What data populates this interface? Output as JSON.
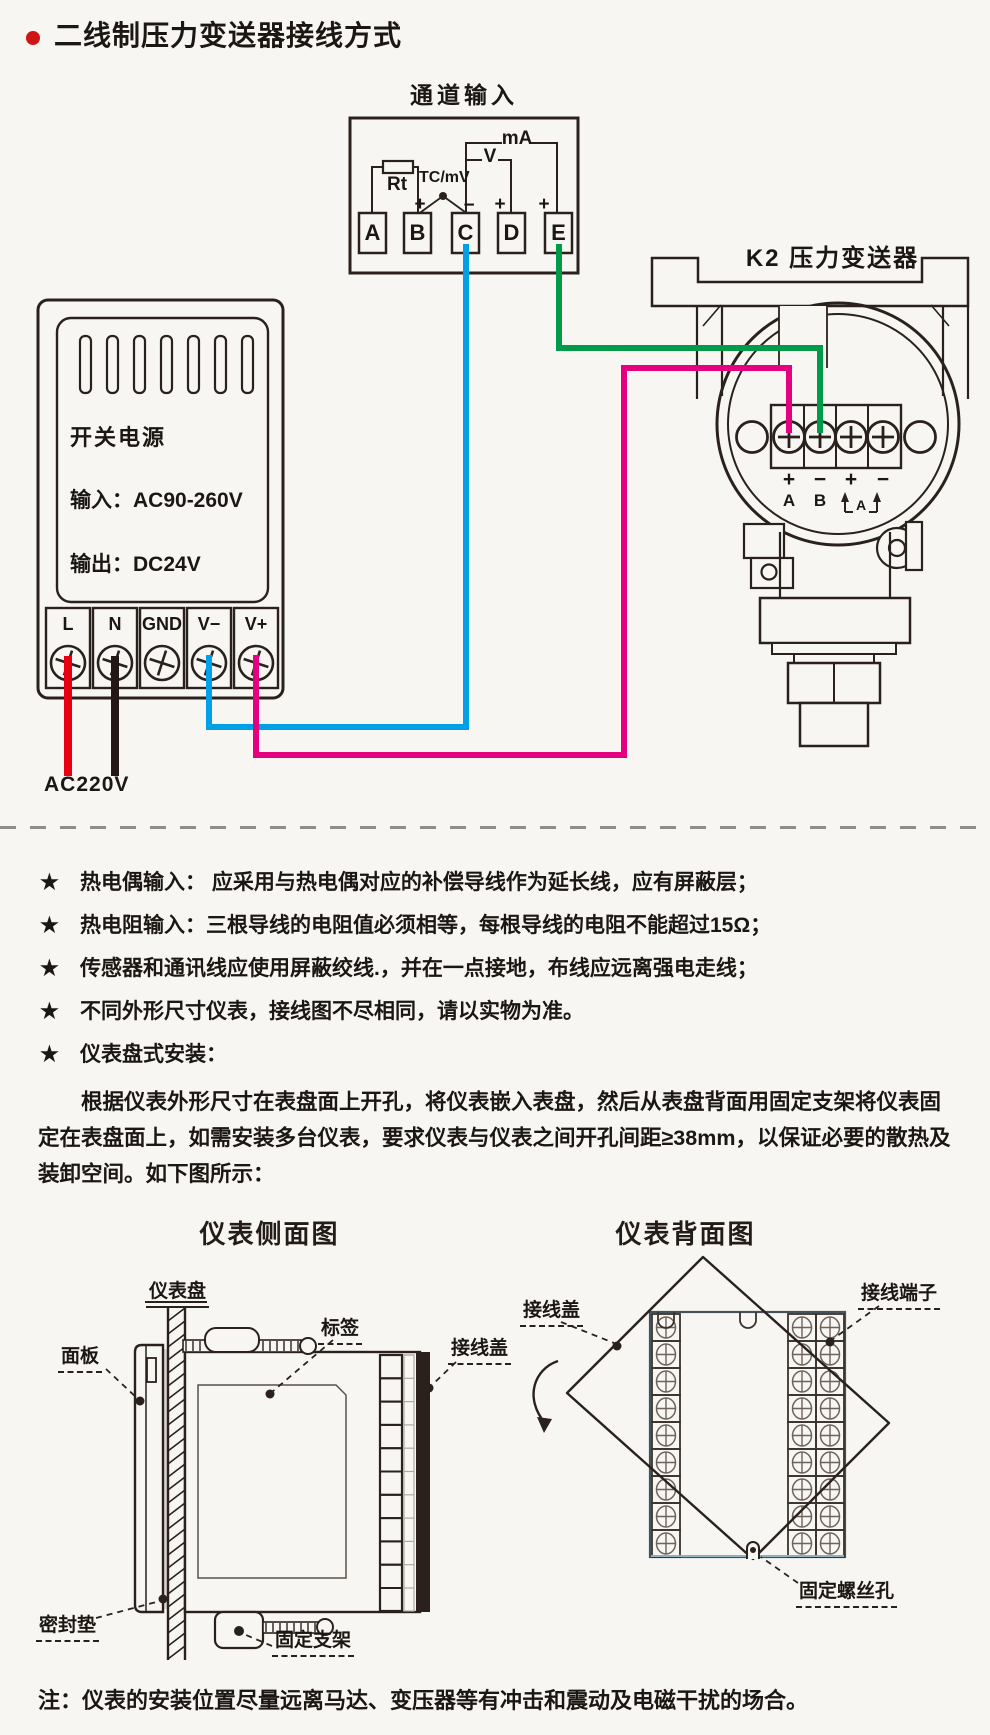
{
  "page": {
    "background": "#f7f6f3",
    "ink": "#2b211c"
  },
  "header": {
    "bullet_color": "#cf1616",
    "title": "二线制压力变送器接线方式"
  },
  "wiring": {
    "channel_box": {
      "title": "通道输入",
      "terminals": [
        "A",
        "B",
        "C",
        "D",
        "E"
      ],
      "rt": "Rt",
      "tc": "TC/mV",
      "v": "V",
      "ma": "mA",
      "sign_b": "+",
      "sign_c": "−",
      "sign_d": "+",
      "sign_e": "+"
    },
    "psu": {
      "name": "开关电源",
      "input": "输入：AC90-260V",
      "output": "输出：DC24V",
      "terminals": [
        "L",
        "N",
        "GND",
        "V−",
        "V+"
      ],
      "mains": "AC220V"
    },
    "transmitter": {
      "title": "K2 压力变送器",
      "signs": [
        "+",
        "−",
        "+",
        "−"
      ],
      "ch_a": "A",
      "ch_b": "B",
      "loop": "A"
    },
    "wires": {
      "live": "#e60012",
      "neutral": "#231815",
      "v_minus": "#00a0e9",
      "v_plus": "#e4007f",
      "signal": "#009a49"
    }
  },
  "notes": {
    "bullet": "★",
    "items": [
      "热电偶输入： 应采用与热电偶对应的补偿导线作为延长线，应有屏蔽层；",
      "热电阻输入：三根导线的电阻值必须相等，每根导线的电阻不能超过15Ω；",
      "传感器和通讯线应使用屏蔽绞线.，并在一点接地，布线应远离强电走线；",
      "不同外形尺寸仪表，接线图不尽相同，请以实物为准。",
      "仪表盘式安装："
    ]
  },
  "install": {
    "paragraph": "根据仪表外形尺寸在表盘面上开孔，将仪表嵌入表盘，然后从表盘背面用固定支架将仪表固定在表盘面上，如需安装多台仪表，要求仪表与仪表之间开孔间距≥38mm，以保证必要的散热及装卸空间。如下图所示："
  },
  "figures": {
    "side": {
      "title": "仪表侧面图",
      "labels": {
        "panel_board": "仪表盘",
        "front_panel": "面板",
        "tag": "标签",
        "cover": "接线盖",
        "gasket": "密封垫",
        "bracket": "固定支架"
      }
    },
    "back": {
      "title": "仪表背面图",
      "labels": {
        "cover": "接线盖",
        "terminals": "接线端子",
        "screw_hole": "固定螺丝孔"
      }
    }
  },
  "footer": {
    "note": "注：仪表的安装位置尽量远离马达、变压器等有冲击和震动及电磁干扰的场合。"
  }
}
